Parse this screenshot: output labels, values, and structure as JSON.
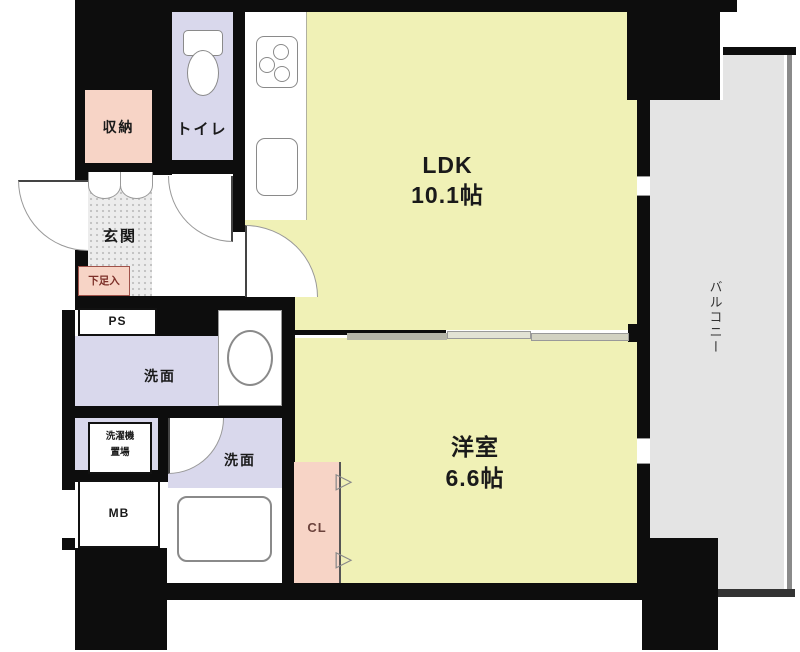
{
  "rooms": {
    "ldk": {
      "label": "LDK",
      "size": "10.1帖"
    },
    "western_room": {
      "label": "洋室",
      "size": "6.6帖"
    },
    "balcony": {
      "label": "バルコニー"
    },
    "toilet": {
      "label": "トイレ"
    },
    "entrance": {
      "label": "玄関"
    },
    "storage": {
      "label": "収納"
    },
    "shoe_cabinet": {
      "label": "下足入"
    },
    "pipe_space": {
      "label": "PS"
    },
    "washroom": {
      "label": "洗面"
    },
    "washing_machine": {
      "line1": "洗濯機",
      "line2": "置場"
    },
    "bath_washroom": {
      "label": "洗面"
    },
    "meter_box": {
      "label": "MB"
    },
    "closet": {
      "label": "CL"
    },
    "closet_door_glyph": "▷"
  },
  "colors": {
    "wall": "#0d0d0d",
    "room_yellow": "#f0f1b6",
    "lavender": "#d9d8ec",
    "pink": "#f7d4c6",
    "balcony_gray": "#e4e4e4",
    "entrance_gray": "#ececec"
  }
}
